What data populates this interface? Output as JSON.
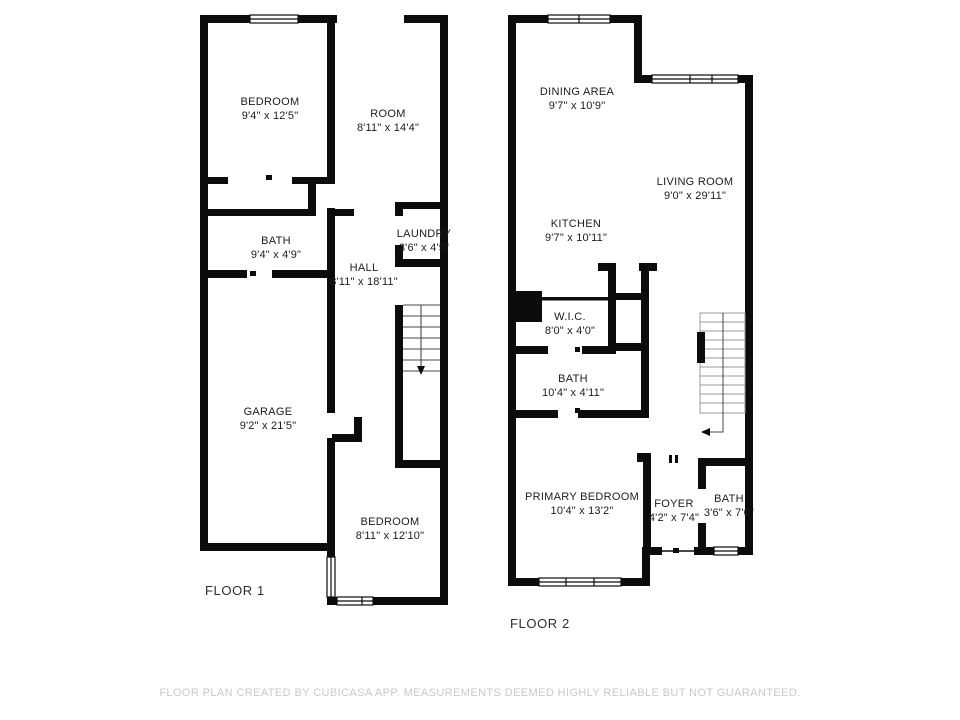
{
  "floors": [
    {
      "label": "FLOOR 1",
      "rooms": [
        {
          "name": "BEDROOM",
          "dims": "9'4\" x 12'5\""
        },
        {
          "name": "ROOM",
          "dims": "8'11\" x 14'4\""
        },
        {
          "name": "BATH",
          "dims": "9'4\" x 4'9\""
        },
        {
          "name": "LAUNDRY",
          "dims": "3'6\" x 4'5\""
        },
        {
          "name": "HALL",
          "dims": "8'11\" x 18'11\""
        },
        {
          "name": "GARAGE",
          "dims": "9'2\" x 21'5\""
        },
        {
          "name": "BEDROOM",
          "dims": "8'11\" x 12'10\""
        }
      ]
    },
    {
      "label": "FLOOR 2",
      "rooms": [
        {
          "name": "DINING AREA",
          "dims": "9'7\" x 10'9\""
        },
        {
          "name": "LIVING ROOM",
          "dims": "9'0\" x 29'11\""
        },
        {
          "name": "KITCHEN",
          "dims": "9'7\" x 10'11\""
        },
        {
          "name": "W.I.C.",
          "dims": "8'0\" x 4'0\""
        },
        {
          "name": "BATH",
          "dims": "10'4\" x 4'11\""
        },
        {
          "name": "PRIMARY BEDROOM",
          "dims": "10'4\" x 13'2\""
        },
        {
          "name": "FOYER",
          "dims": "4'2\" x 7'4\""
        },
        {
          "name": "BATH",
          "dims": "3'6\" x 7'0\""
        }
      ]
    }
  ],
  "footer": {
    "disclaimer": "FLOOR PLAN CREATED BY CUBICASA APP. MEASUREMENTS DEEMED HIGHLY RELIABLE BUT NOT GUARANTEED."
  },
  "colors": {
    "wall": "#0c0c0c",
    "room_text": "#1c1c1c",
    "floor_label_text": "#2e2e2e",
    "footer_text": "#c9c9c9",
    "background": "#ffffff",
    "stair_tread": "#8a8a8a"
  }
}
